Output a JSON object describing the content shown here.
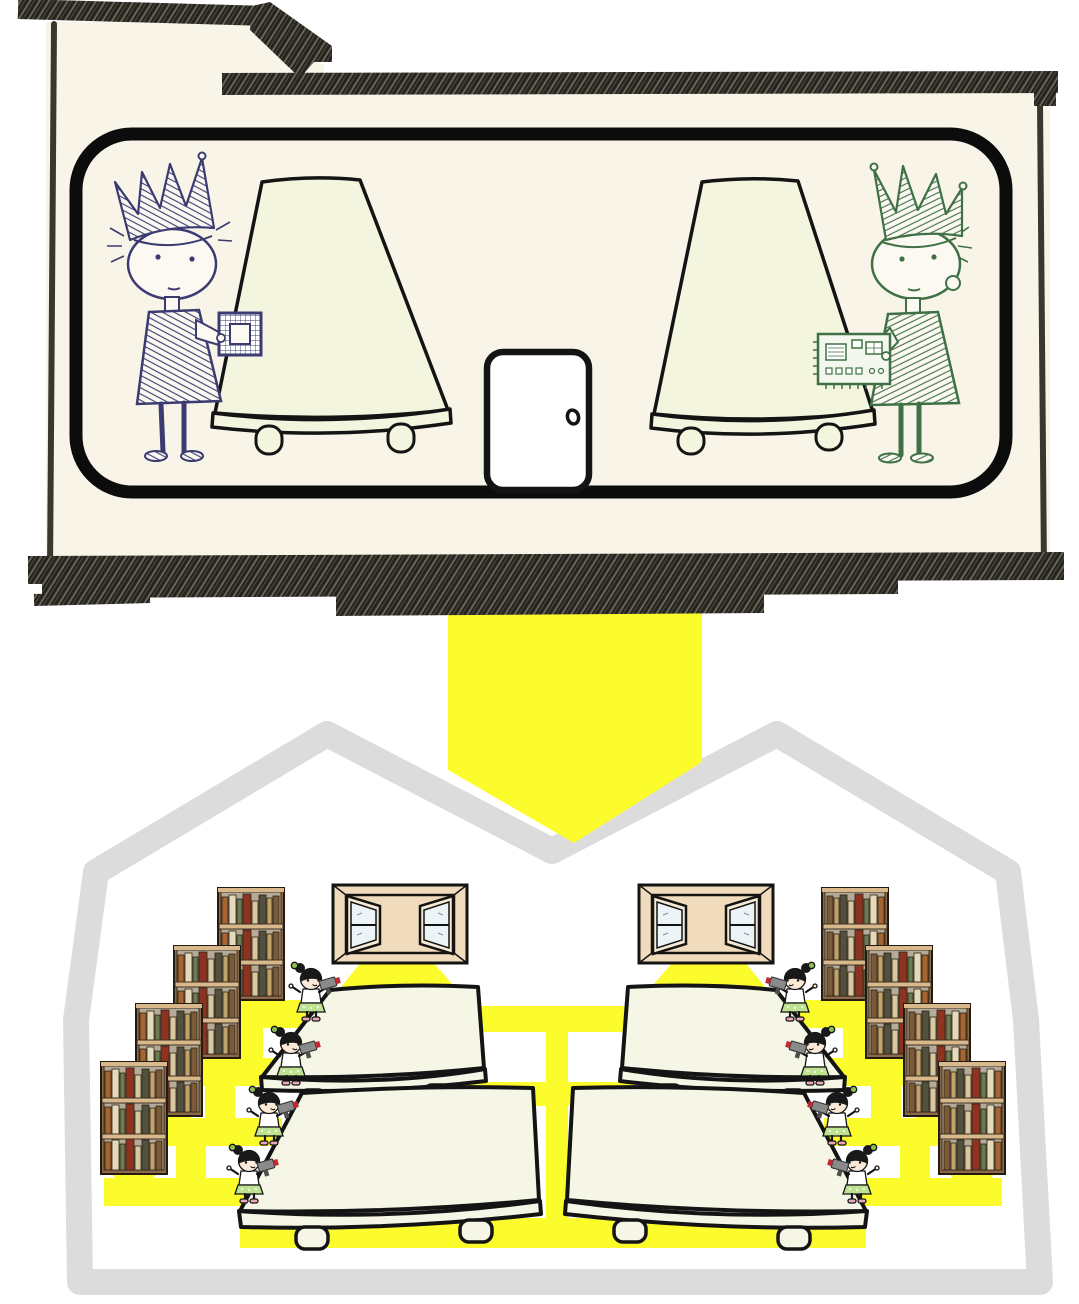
{
  "palette": {
    "page_bg": "#ffffff",
    "house_fill": "#f8f5e8",
    "ink": "#141414",
    "wall_ink": "#3a382e",
    "room_border": "#0c0c0c",
    "roof_texture": "#262420",
    "roof_hatch_line": "#716b5a",
    "table_fill_top": "#f3f5df",
    "table_fill_bottom": "#f6f6e7",
    "door_fill": "#ffffff",
    "navy": "#3b3b72",
    "green": "#3f7046",
    "king_paper": "#fbf9f1",
    "arrow_yellow": "#fcfc2d",
    "path_yellow": "#fcfc2d",
    "outline_gray": "#dcdcdc",
    "wood_frame": "#8a6848",
    "wood_shelf": "#d9b98c",
    "shelf_back": "#b5ab98",
    "window_frame": "#f0dcbc",
    "window_casement": "#f6ead2",
    "glass": "#edf4f8",
    "girl_skin": "#f9e9d6",
    "girl_hair": "#191919",
    "girl_skirt": "#c0e392",
    "girl_bow": "#8cc152",
    "girl_shoe": "#e8a8b8",
    "drill_gray": "#8a8a8a",
    "drill_dark": "#4f4f4f",
    "drill_tip_red": "#c22a33"
  },
  "book_spines": [
    "#a8652f",
    "#e6d9ba",
    "#6d7b52",
    "#8e3320",
    "#d9c7a0",
    "#53503e",
    "#c2a36a",
    "#7c5a36"
  ],
  "scene": {
    "top_room": {
      "left_figure": {
        "id": "crowned-child-navy",
        "holding": "cpu-chip"
      },
      "right_figure": {
        "id": "crowned-child-green",
        "holding": "circuit-board"
      },
      "tables": 2,
      "doors": 1
    },
    "transition": {
      "type": "arrow",
      "direction": "down",
      "glyph": "⬇"
    },
    "workshop": {
      "bookcases": 8,
      "windows": 2,
      "tables": 4,
      "workers": 8,
      "worker_tool": "drill",
      "light_beams": 2
    }
  }
}
